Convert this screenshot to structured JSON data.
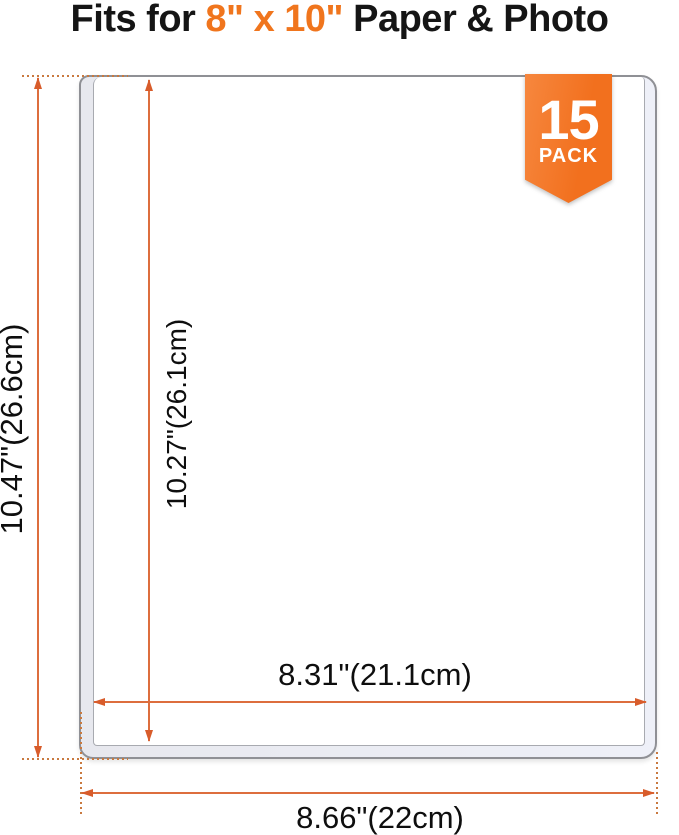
{
  "title": {
    "prefix": "Fits for ",
    "highlight": "8\" x 10\"",
    "suffix": " Paper & Photo"
  },
  "badge": {
    "count": "15",
    "label": "PACK"
  },
  "dimensions": {
    "outer_height_label": "10.47\"(26.6cm)",
    "inner_height_label": "10.27\"(26.1cm)",
    "inner_width_label": "8.31\"(21.1cm)",
    "outer_width_label": "8.66\"(22cm)"
  },
  "colors": {
    "accent_orange": "#F2701E",
    "title_highlight": "#F0751D",
    "arrow_orange": "#DD6E3E",
    "arrowhead_orange": "#D85C2B",
    "dotted_line": "#C9793F",
    "sleeve_border": "#8F9095",
    "sleeve_band": "#EEF0F8"
  }
}
